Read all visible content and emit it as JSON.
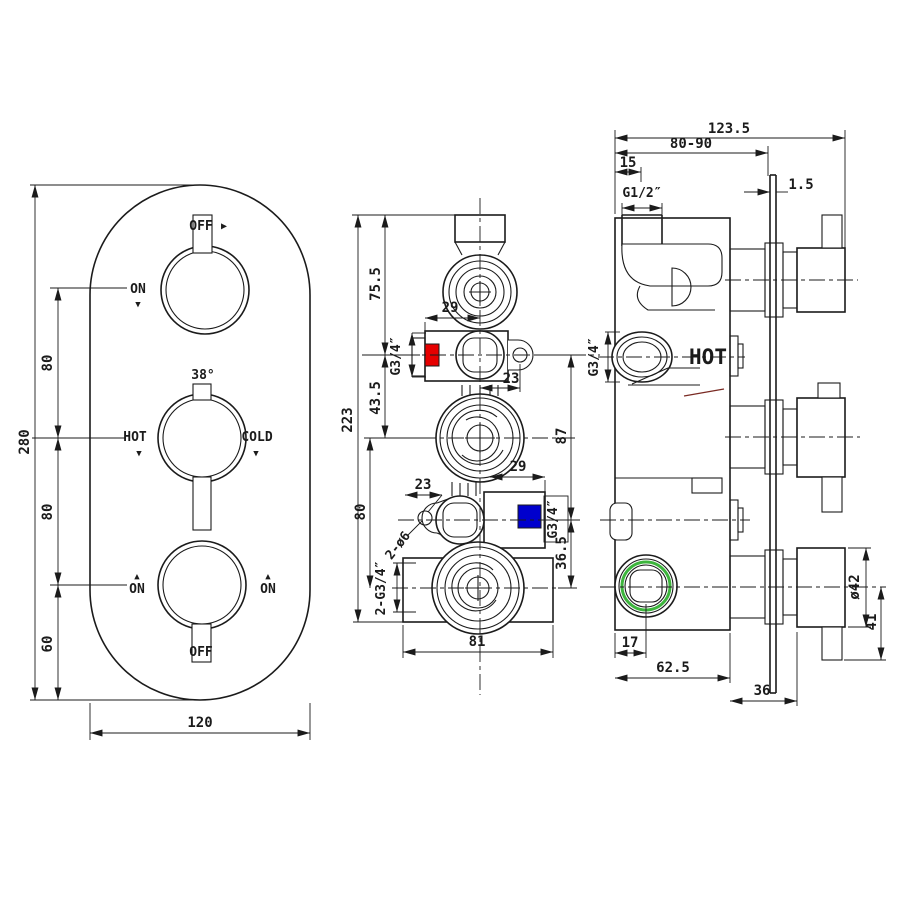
{
  "front_view": {
    "labels": {
      "off_top": "OFF",
      "arrow_right": "▶",
      "on_left": "ON",
      "down_triangle": "▼",
      "temp": "38°",
      "hot": "HOT",
      "cold": "COLD",
      "up_triangle": "▲",
      "on_bottom_left": "ON",
      "on_bottom_right": "ON",
      "off_bottom": "OFF"
    },
    "dims": {
      "height": "280",
      "upper_gap": "80",
      "lower_gap": "80",
      "bottom_gap": "60",
      "width": "120"
    }
  },
  "section_view": {
    "dims": {
      "top_offset": "75.5",
      "top_width": "29",
      "mid_offset": "43.5",
      "height": "223",
      "knob_gap": "80",
      "right_span": "87",
      "mid_width": "29",
      "hole_offset_top": "23",
      "hole_offset_mid": "23",
      "bottom_right": "36.5",
      "body_width": "81"
    },
    "labels": {
      "inlet_top": "G3/4″",
      "inlet_mid": "G3/4″",
      "mount_holes": "2-ø6",
      "outlets": "2-G3/4″"
    }
  },
  "side_view": {
    "dims": {
      "total_depth": "123.5",
      "wall_range": "80-90",
      "outlet_offset": "15",
      "plate_thick": "1.5",
      "handle_dia": "ø42",
      "handle_len": "41",
      "port_offset": "17",
      "body_depth": "62.5",
      "stem_depth": "36"
    },
    "labels": {
      "outlet_thread": "G1/2″",
      "inlet_thread": "G3/4″",
      "hot": "HOT"
    }
  },
  "colors": {
    "hot_marker": "#e60000",
    "cold_marker": "#0000cd",
    "seal_ring": "#3db53d",
    "ink": "#1b1b1b",
    "section_line": "#7a2a23"
  }
}
